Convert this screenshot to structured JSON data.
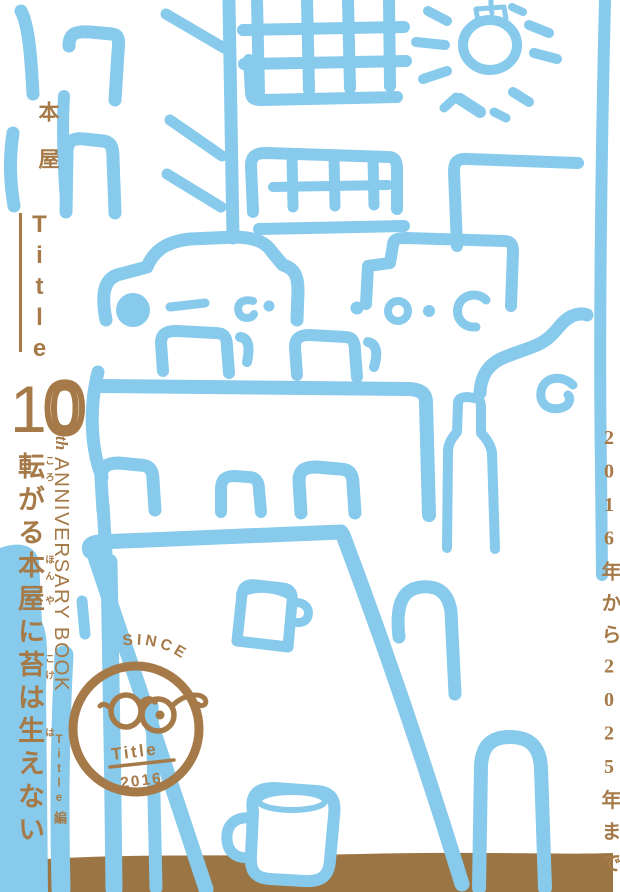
{
  "poster": {
    "publisher": "本屋",
    "logo": "Title",
    "anniversary": {
      "digit_1": "1",
      "digit_0": "0",
      "suffix": "th",
      "label": "ANNIVERSARY BOOK"
    },
    "headline": {
      "full": "転がる本屋に苔は生えない",
      "segments": [
        {
          "base": "転",
          "ruby": "ころ"
        },
        {
          "base": "がる",
          "ruby": ""
        },
        {
          "base": "本",
          "ruby": "ほん"
        },
        {
          "base": "屋",
          "ruby": "や"
        },
        {
          "base": "に",
          "ruby": ""
        },
        {
          "base": "苔",
          "ruby": "こけ"
        },
        {
          "base": "は",
          "ruby": ""
        },
        {
          "base": "生",
          "ruby": "は"
        },
        {
          "base": "えない",
          "ruby": ""
        }
      ]
    },
    "editor": {
      "latin": "Title",
      "suffix": "編"
    },
    "period": "2016年から2025年まで",
    "stamp": {
      "arc": "SINCE",
      "name": "Title",
      "year": "2016"
    },
    "colors": {
      "sketch_blue": "#87CAEC",
      "text_brown": "#A57A48",
      "floor_brown": "#9C7544",
      "background": "#FFFFFF"
    }
  }
}
